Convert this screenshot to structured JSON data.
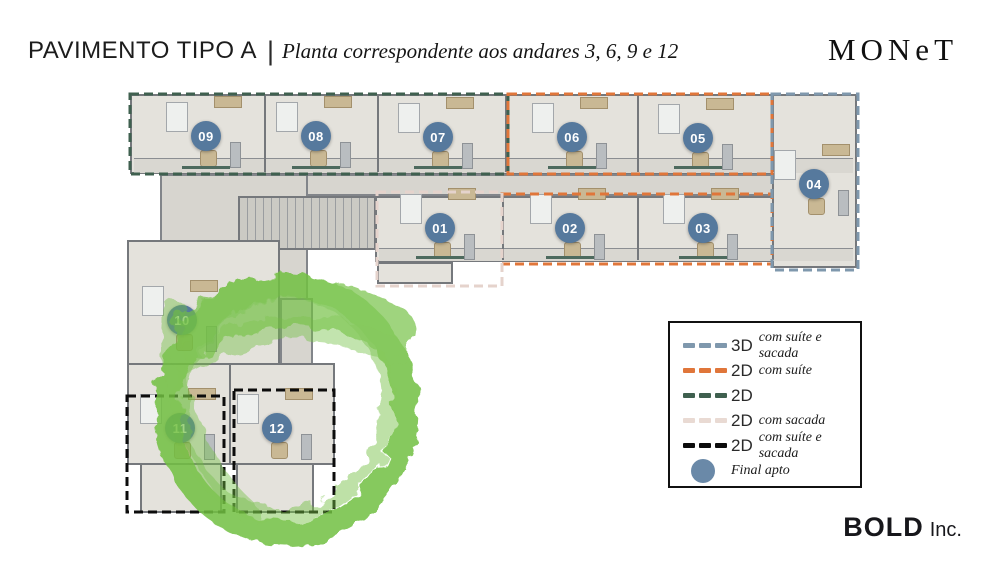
{
  "header": {
    "title": "PAVIMENTO TIPO A",
    "separator": "|",
    "subtitle": "Planta correspondente aos andares 3, 6, 9 e 12",
    "brand": "MONeT"
  },
  "floorplan": {
    "units": [
      {
        "label": "01",
        "x": 440,
        "y": 228
      },
      {
        "label": "02",
        "x": 570,
        "y": 228
      },
      {
        "label": "03",
        "x": 703,
        "y": 228
      },
      {
        "label": "04",
        "x": 814,
        "y": 184
      },
      {
        "label": "05",
        "x": 698,
        "y": 138
      },
      {
        "label": "06",
        "x": 572,
        "y": 137
      },
      {
        "label": "07",
        "x": 438,
        "y": 137
      },
      {
        "label": "08",
        "x": 316,
        "y": 136
      },
      {
        "label": "09",
        "x": 206,
        "y": 136
      },
      {
        "label": "10",
        "x": 182,
        "y": 320
      },
      {
        "label": "11",
        "x": 180,
        "y": 428
      },
      {
        "label": "12",
        "x": 277,
        "y": 428
      }
    ],
    "outlines": [
      {
        "type": "2D",
        "color": "#3f604f",
        "x": 130,
        "y": 94,
        "w": 378,
        "h": 80
      },
      {
        "type": "2D com suíte",
        "color": "#e0763a",
        "x": 508,
        "y": 94,
        "w": 264,
        "h": 80
      },
      {
        "type": "2D com suíte",
        "color": "#e0763a",
        "x": 502,
        "y": 194,
        "w": 270,
        "h": 70
      },
      {
        "type": "3D com suíte e sacada",
        "color": "#7f98ad",
        "x": 772,
        "y": 94,
        "w": 86,
        "h": 176
      },
      {
        "type": "2D com sacada",
        "color": "#e5d3cc",
        "x": 377,
        "y": 192,
        "w": 125,
        "h": 94
      },
      {
        "type": "2D com suíte e sacada",
        "color": "#0c0c0c",
        "x": 127,
        "y": 396,
        "w": 97,
        "h": 116
      },
      {
        "type": "2D com suíte e sacada",
        "color": "#0c0c0c",
        "x": 234,
        "y": 390,
        "w": 100,
        "h": 122
      }
    ],
    "highlight_color": "#72c042"
  },
  "legend": {
    "items": [
      {
        "code": "3D",
        "desc": "com suíte e sacada",
        "color": "#7f98ad",
        "sample": "dash"
      },
      {
        "code": "2D",
        "desc": "com suíte",
        "color": "#e0763a",
        "sample": "dash"
      },
      {
        "code": "2D",
        "desc": "",
        "color": "#3f604f",
        "sample": "dash"
      },
      {
        "code": "2D",
        "desc": "com sacada",
        "color": "#e9dad3",
        "sample": "dash"
      },
      {
        "code": "2D",
        "desc": "com suíte e sacada",
        "color": "#0c0c0c",
        "sample": "dash"
      },
      {
        "code": "",
        "desc": "Final apto",
        "color": "#6a89a8",
        "sample": "circle"
      }
    ]
  },
  "footer": {
    "brand_bold": "BOLD",
    "brand_suffix": "Inc."
  }
}
